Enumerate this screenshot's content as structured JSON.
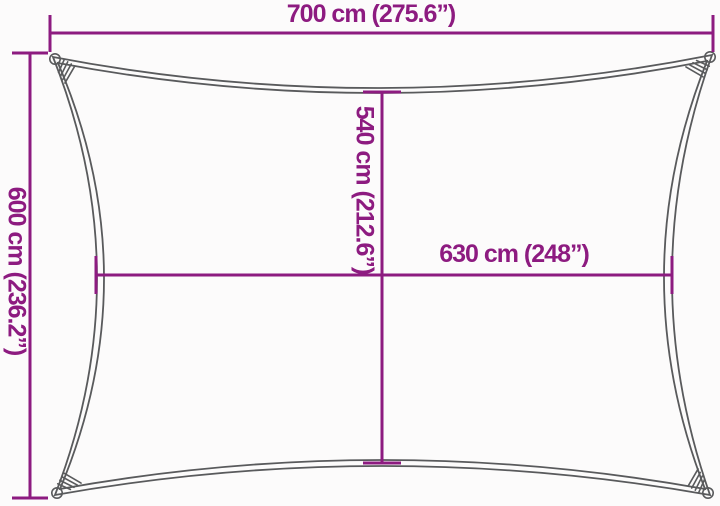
{
  "diagram": {
    "subject": "rectangular-sun-shade-sail-dimension-diagram",
    "colors": {
      "dimension_accent": "#8d1b80",
      "sail_outline_gray": "#595a5c",
      "background": "#fcfbfb"
    },
    "dimensions": {
      "top_width": {
        "label": "700 cm (275.6”)"
      },
      "left_height": {
        "label": "600 cm (236.2”)"
      },
      "inner_height": {
        "label": "540 cm (212.6”)"
      },
      "inner_width": {
        "label": "630 cm (248”)"
      }
    }
  }
}
